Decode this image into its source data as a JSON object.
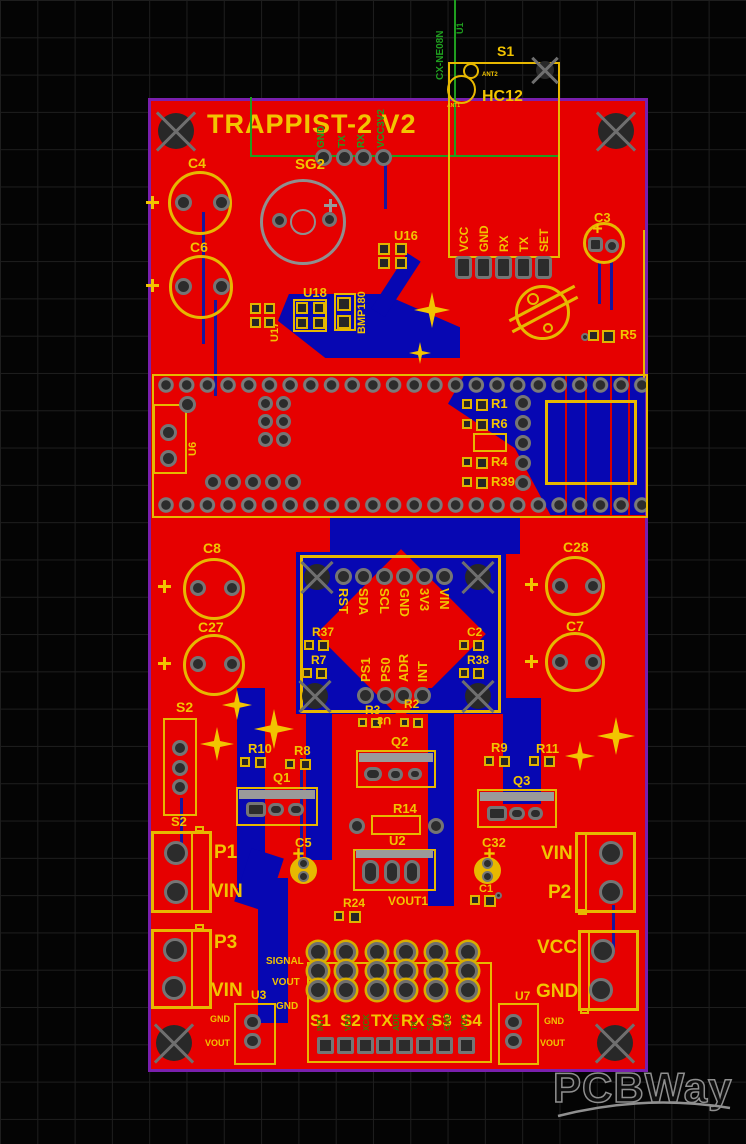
{
  "app": {
    "watermark": "PCBWay"
  },
  "palette": {
    "board_red": "#e60000",
    "silk_yellow": "#f2c400",
    "copper_blue": "#0707b2",
    "outline_purple": "#7a1fae",
    "silk_green": "#1f9e1f",
    "silk_gray": "#9a9a9a"
  },
  "board": {
    "title": "TRAPPIST-2 V2"
  },
  "overlay_top": {
    "vertical_text": "CX-NE08N",
    "ref": "U1"
  },
  "radio": {
    "ref": "S1",
    "part": "HC12",
    "ant1": "ANT1",
    "ant2": "ANT2",
    "side_pins": [
      "GND",
      "TX",
      "RX",
      "VCC3V2"
    ],
    "header_pins": [
      "VCC",
      "GND",
      "RX",
      "TX",
      "SET"
    ]
  },
  "buzzer": {
    "ref": "SG2"
  },
  "caps": {
    "c4": "C4",
    "c6": "C6",
    "c3": "C3",
    "c8": "C8",
    "c27": "C27",
    "c28": "C28",
    "c7": "C7",
    "c5": "C5",
    "c32": "C32",
    "c1": "C1",
    "c2": "C2"
  },
  "ics": {
    "u16": "U16",
    "u18": "U18",
    "u17": "U17",
    "bmp180": "BMP180",
    "u6": "U6",
    "u8": "U8",
    "u2": "U2"
  },
  "res": {
    "r5": "R5",
    "r1": "R1",
    "r6": "R6",
    "r4": "R4",
    "r39": "R39",
    "r37": "R37",
    "r7": "R7",
    "r38": "R38",
    "r3": "R3",
    "r2": "R2",
    "r14": "R14",
    "r24": "R24",
    "r10": "R10",
    "r8": "R8",
    "r9": "R9",
    "r11": "R11"
  },
  "socket": {
    "top_pins": [
      "RST",
      "SDA",
      "SCL",
      "GND",
      "3V3",
      "VIN"
    ],
    "bottom_pins": [
      "PS1",
      "PS0",
      "ADR",
      "INT"
    ]
  },
  "transistors": {
    "q1": "Q1",
    "q2": "Q2",
    "q3": "Q3"
  },
  "s2": {
    "top": "S2",
    "bottom": "S2"
  },
  "power": {
    "p1": "P1",
    "p1_rail": "VIN",
    "p3": "P3",
    "p3_rail": "VIN",
    "p2": "P2",
    "p2_rail": "VIN",
    "vcc": "VCC",
    "gnd": "GND",
    "vout1": "VOUT1"
  },
  "reg_u3": {
    "ref": "U3",
    "gnd": "GND",
    "vout": "VOUT"
  },
  "reg_u7": {
    "ref": "U7",
    "gnd": "GND",
    "vout": "VOUT"
  },
  "bottom_left_pins": {
    "signal": "SIGNAL",
    "vout": "VOUT",
    "gnd": "GND"
  },
  "bottom_header": {
    "labels": [
      "S1",
      "S2",
      "TX",
      "RX",
      "S3",
      "S4"
    ],
    "green_labels": [
      "INT",
      "VDD",
      "XCK",
      "ADR",
      "TX",
      "SCL",
      "GND",
      "VCC"
    ]
  }
}
